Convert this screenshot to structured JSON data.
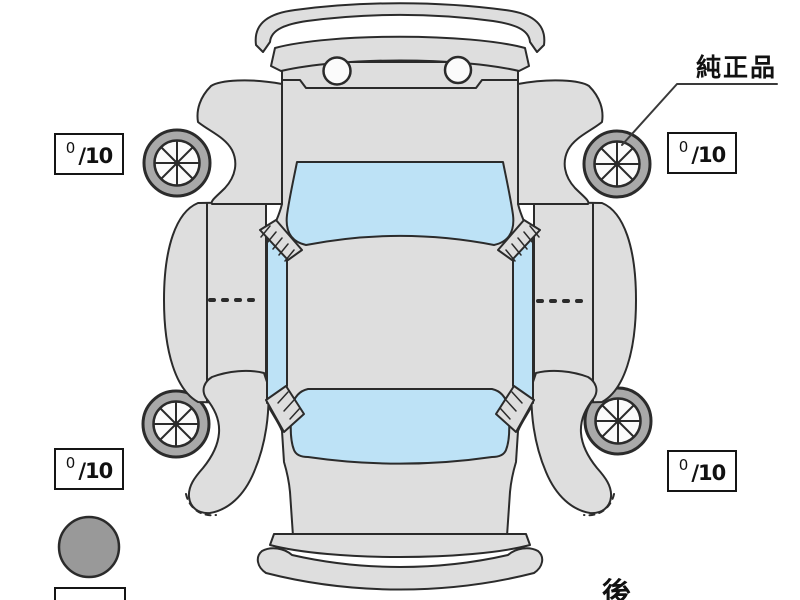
{
  "diagram": {
    "type": "vehicle-condition-top-view",
    "labels": {
      "genuine_part": "純正品",
      "rear": "後"
    },
    "tires": [
      {
        "position": "front-left",
        "value": "0",
        "denominator": "/10"
      },
      {
        "position": "front-right",
        "value": "0",
        "denominator": "/10"
      },
      {
        "position": "rear-left",
        "value": "0",
        "denominator": "/10"
      },
      {
        "position": "rear-right",
        "value": "0",
        "denominator": "/10"
      }
    ],
    "markers": {
      "filled_circle_color": "#999999"
    },
    "colors": {
      "body": "#dedede",
      "glass": "#bde2f6",
      "tire_ring": "#a9a9a9",
      "outline": "#2b2b2b",
      "background": "#ffffff"
    }
  }
}
